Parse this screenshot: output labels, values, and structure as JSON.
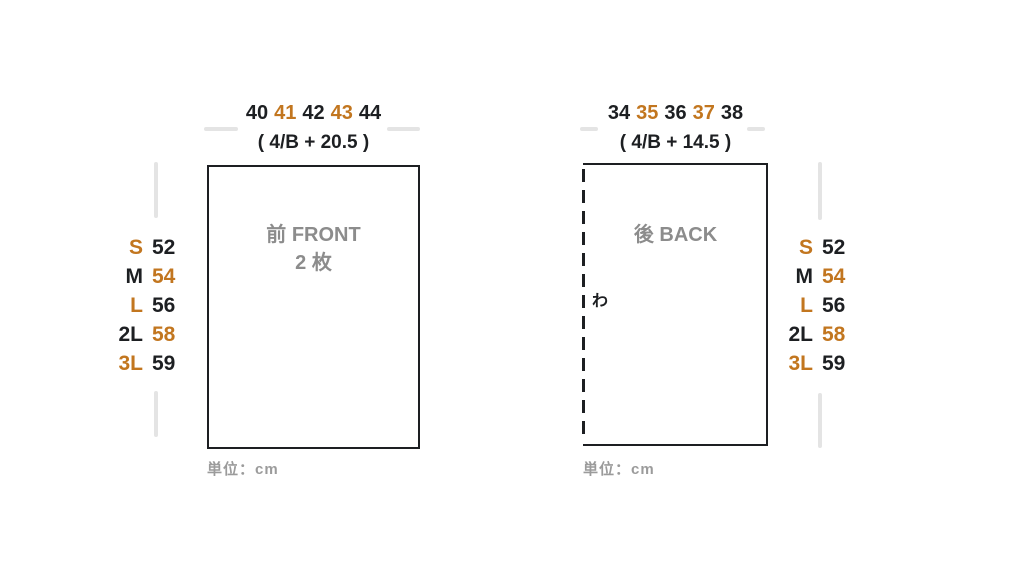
{
  "colors": {
    "accent": "#c2761f",
    "ink": "#1d1f22",
    "piece_label": "#8c8c8c",
    "unit_note": "#9b9b9b",
    "dim_line": "#e4e4e4"
  },
  "front": {
    "width_values": [
      "40",
      "41",
      "42",
      "43",
      "44"
    ],
    "formula": "( 4/B + 20.5 )",
    "label_line1": "前 FRONT",
    "label_line2": "2 枚",
    "unit_note": "単位：cm"
  },
  "back": {
    "width_values": [
      "34",
      "35",
      "36",
      "37",
      "38"
    ],
    "formula": "( 4/B + 14.5 )",
    "label_line1": "後 BACK",
    "fold_label": "わ",
    "unit_note": "単位：cm"
  },
  "sizes": [
    {
      "size": "S",
      "value": "52"
    },
    {
      "size": "M",
      "value": "54"
    },
    {
      "size": "L",
      "value": "56"
    },
    {
      "size": "2L",
      "value": "58"
    },
    {
      "size": "3L",
      "value": "59"
    }
  ]
}
